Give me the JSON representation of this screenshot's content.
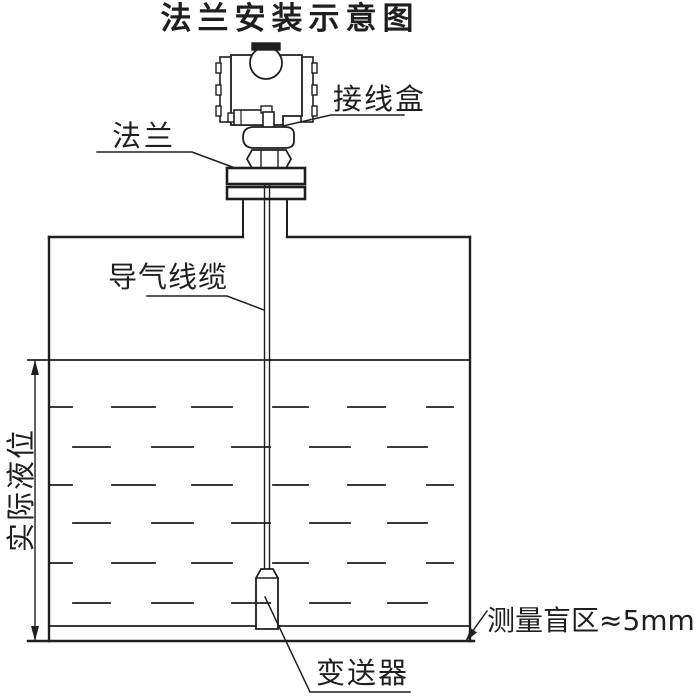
{
  "title": "法兰安装示意图",
  "colors": {
    "line": "#1f1f1f",
    "background": "#ffffff"
  },
  "labels": {
    "junction_box": "接线盒",
    "flange": "法兰",
    "air_cable": "导气线缆",
    "actual_level": "实际液位",
    "blind_zone": "测量盲区≈5mm",
    "transmitter": "变送器"
  }
}
